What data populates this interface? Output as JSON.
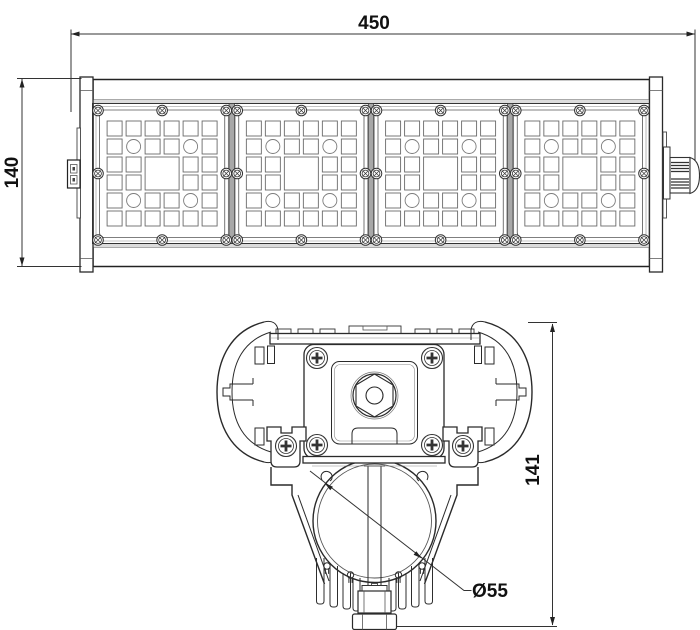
{
  "drawing": {
    "kind": "technical-drawing",
    "front_view": {
      "width_label": "450",
      "height_label": "140",
      "module_count": 4
    },
    "profile_view": {
      "height_label": "141",
      "diameter_label": "Ø55"
    },
    "colors": {
      "line": "#222222",
      "background": "#ffffff",
      "divider_gray": "#a8a8a8"
    }
  }
}
